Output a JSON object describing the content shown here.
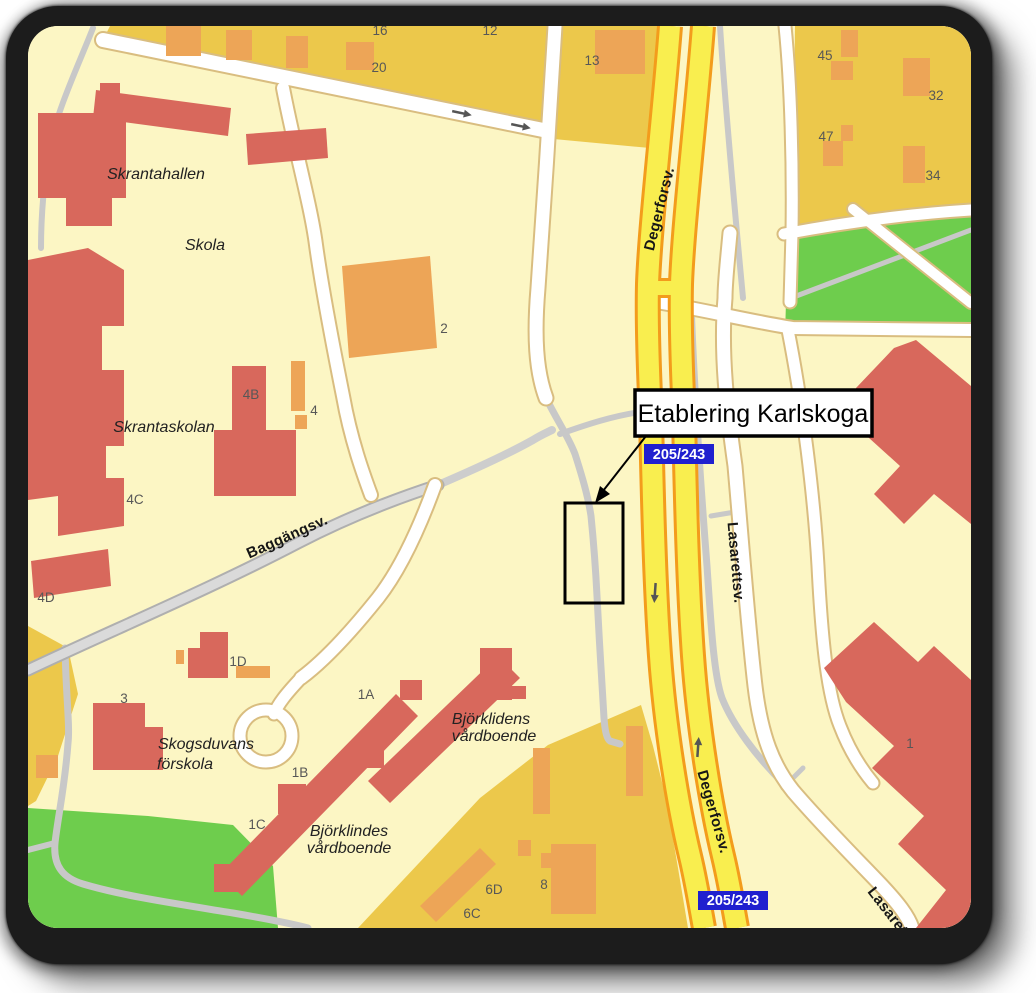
{
  "annotation": {
    "text": "Etablering Karlskoga"
  },
  "badges": {
    "north": "205/243",
    "south": "205/243"
  },
  "streets": {
    "degerforsv_north": "Degerforsv.",
    "degerforsv_south": "Degerforsv.",
    "lasarettsv": "Lasarettsv.",
    "lasarettsv_corner": "Lasarettsv.",
    "baggangsv": "Baggängsv."
  },
  "places": {
    "skrantahallen": "Skrantahallen",
    "skola": "Skola",
    "skrantaskolan": "Skrantaskolan",
    "skogsduvans_line1": "Skogsduvans",
    "skogsduvans_line2": "förskola",
    "bjorklidens_line1": "Björklidens",
    "bjorklidens_line2": "vårdboende",
    "bjorklindes_line1": "Björklindes",
    "bjorklindes_line2": "vårdboende"
  },
  "numbers": {
    "n16": "16",
    "n12": "12",
    "n20": "20",
    "n13": "13",
    "n45": "45",
    "n32": "32",
    "n47": "47",
    "n34": "34",
    "n2": "2",
    "n4b": "4B",
    "n4": "4",
    "n4c": "4C",
    "n4d": "4D",
    "n1d": "1D",
    "n3": "3",
    "n1a": "1A",
    "n1b": "1B",
    "n1c": "1C",
    "n6d": "6D",
    "n8": "8",
    "n6c": "6C",
    "n1": "1"
  },
  "colors": {
    "cream": "#FCF6C4",
    "block_gold": "#ECC84B",
    "green": "#6ECD4D",
    "building_red": "#D8685C",
    "building_orange": "#EDA557",
    "road_yellow": "#F9EE4F",
    "road_casing": "#F39C1C",
    "badge_blue": "#2020CF"
  }
}
